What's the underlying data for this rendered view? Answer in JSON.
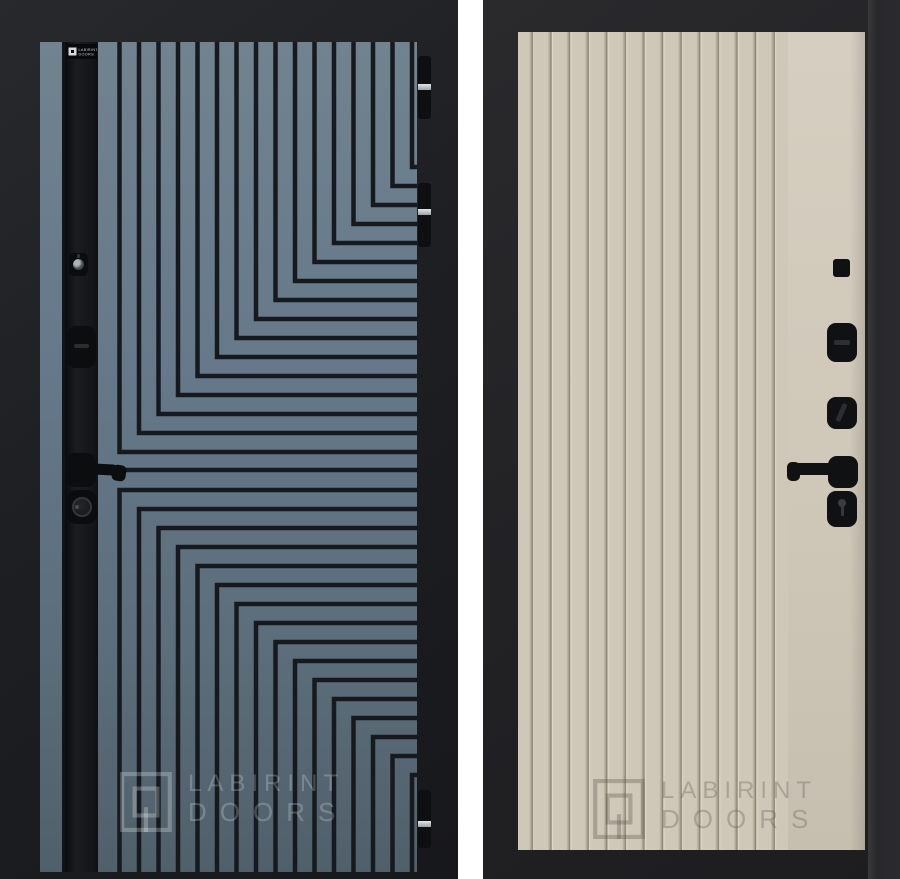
{
  "brand": {
    "name": "LABIRINT DOORS",
    "watermark_line1": "LABIRINT",
    "watermark_line2": "DOORS",
    "plate_line1": "LABIRINT",
    "plate_line2": "DOORS"
  },
  "doors": {
    "left": {
      "side": "exterior",
      "finish": "graphite blue-grey with labyrinth groove pattern",
      "panel_color": "#66798a",
      "groove_color": "#161a1e",
      "accent_strip_color": "#141619",
      "frame_color": "#1f2124",
      "hinge_count": 3,
      "hardware": [
        "keyhole-cylinder",
        "thumbturn-escutcheon",
        "lever-handle",
        "lock-knob"
      ]
    },
    "right": {
      "side": "interior",
      "finish": "beige vertical fluted panel",
      "panel_color": "#cfc8b9",
      "frame_color": "#232326",
      "hardware": [
        "peephole",
        "thumbturn-plate",
        "nightlatch-turn-plate",
        "lever-handle",
        "key-cylinder-plate"
      ]
    }
  },
  "background_color": "#ffffff"
}
